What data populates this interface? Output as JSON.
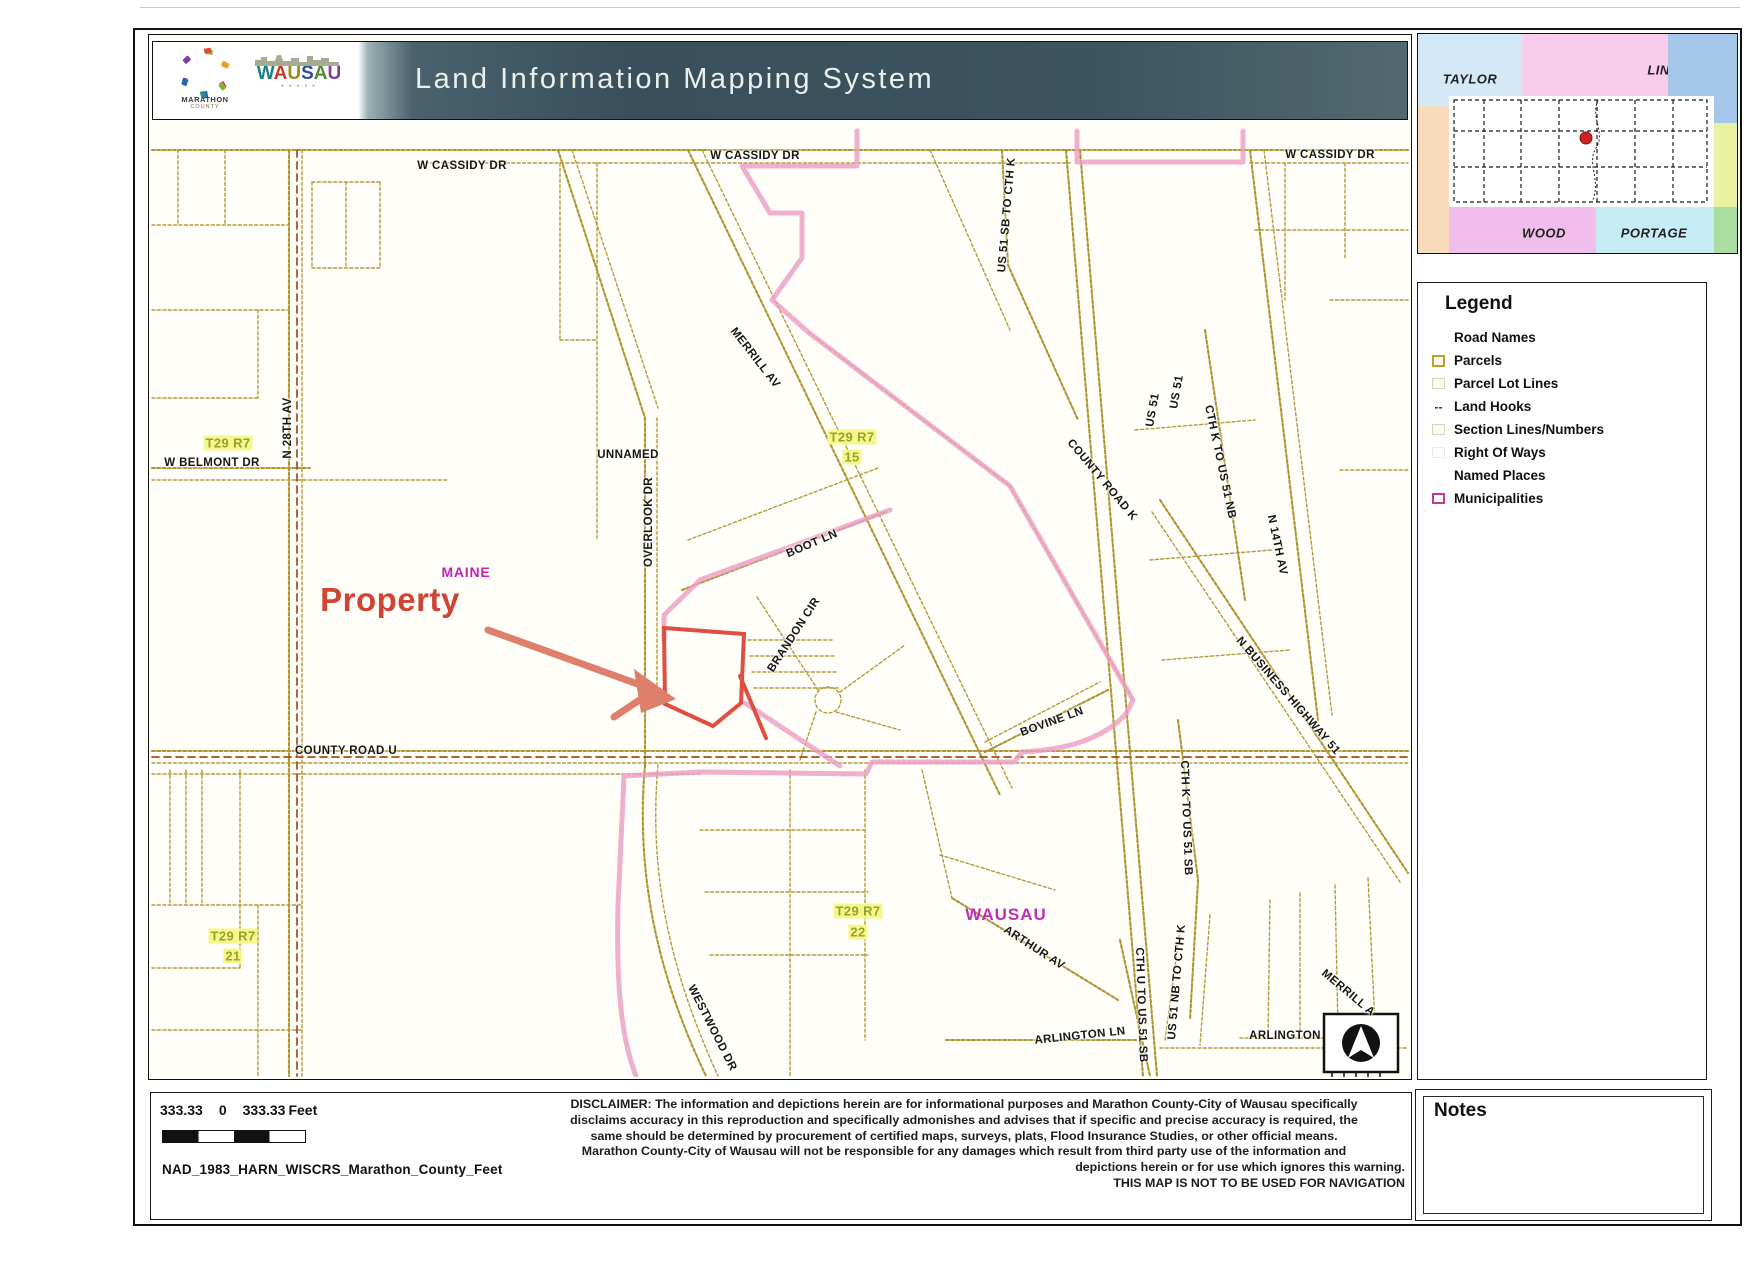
{
  "header": {
    "title": "Land Information Mapping System",
    "marathon_logo": {
      "name": "MARATHON",
      "sub": "COUNTY"
    },
    "wausau_logo": {
      "name": "WAUSAU",
      "letter_colors": [
        "#1b7f8a",
        "#c43a2c",
        "#9a8a1a",
        "#2a4d9c",
        "#4e8d2f",
        "#7d3f96"
      ],
      "dots": "• • • • •"
    }
  },
  "inset": {
    "cells": [
      {
        "label": "TAYLOR",
        "color": "#d4e9f7",
        "x": 0,
        "y": 0,
        "w": 104,
        "h": 72,
        "lx": 52,
        "ly": 45
      },
      {
        "label": "LINCOLN",
        "color": "#f8cdeb",
        "x": 104,
        "y": 0,
        "w": 146,
        "h": 62,
        "lx": 156,
        "ly": 36
      },
      {
        "label": "",
        "color": "#a4c7ea",
        "x": 250,
        "y": 0,
        "w": 69,
        "h": 89
      },
      {
        "label": "",
        "color": "#f8dbba",
        "x": 0,
        "y": 72,
        "w": 31,
        "h": 147
      },
      {
        "label": "",
        "color": "#eaf1a3",
        "x": 296,
        "y": 89,
        "w": 23,
        "h": 84
      },
      {
        "label": "",
        "color": "#ffffff",
        "x": 31,
        "y": 62,
        "w": 265,
        "h": 111
      },
      {
        "label": "WOOD",
        "color": "#f0bdec",
        "x": 31,
        "y": 173,
        "w": 147,
        "h": 46,
        "lx": 95,
        "ly": 26
      },
      {
        "label": "PORTAGE",
        "color": "#c7ecf5",
        "x": 178,
        "y": 173,
        "w": 118,
        "h": 46,
        "lx": 58,
        "ly": 26
      },
      {
        "label": "",
        "color": "#acdda0",
        "x": 296,
        "y": 173,
        "w": 23,
        "h": 46
      }
    ]
  },
  "legend": {
    "title": "Legend",
    "items": [
      {
        "label": "Road Names",
        "icon": "none"
      },
      {
        "label": "Parcels",
        "icon": "parcel"
      },
      {
        "label": "Parcel Lot Lines",
        "icon": "faint"
      },
      {
        "label": "Land Hooks",
        "icon": "dash"
      },
      {
        "label": "Section Lines/Numbers",
        "icon": "faint"
      },
      {
        "label": "Right Of Ways",
        "icon": "faint2"
      },
      {
        "label": "Named Places",
        "icon": "none"
      },
      {
        "label": "Municipalities",
        "icon": "muni"
      }
    ]
  },
  "notes": {
    "title": "Notes"
  },
  "footer": {
    "scale_left": "333.33",
    "scale_zero": "0",
    "scale_right": "333.33",
    "scale_unit": "Feet",
    "projection": "NAD_1983_HARN_WISCRS_Marathon_County_Feet",
    "disclaimer_lines": [
      {
        "text": "DISCLAIMER: The information and depictions herein are for informational purposes and Marathon County-City of Wausau specifically",
        "align": "center"
      },
      {
        "text": "disclaims accuracy in this reproduction and specifically admonishes and advises that if specific and precise accuracy is required, the",
        "align": "center"
      },
      {
        "text": "same should be determined by procurement of certified maps, surveys, plats, Flood Insurance Studies, or other official means.",
        "align": "center"
      },
      {
        "text": "Marathon County-City of Wausau will not be responsible for any damages which result from third party use of the information and",
        "align": "center"
      },
      {
        "text": "depictions herein or for use which ignores this warning.",
        "align": "right"
      },
      {
        "text": "THIS MAP IS NOT TO BE USED FOR NAVIGATION",
        "align": "right"
      }
    ]
  },
  "map": {
    "callout": {
      "label": "Property",
      "target": "highlighted parcel"
    },
    "labels": [
      {
        "text": "W CASSIDY DR",
        "x": 462,
        "y": 166,
        "rot": 0,
        "cls": "rd"
      },
      {
        "text": "W CASSIDY DR",
        "x": 755,
        "y": 156,
        "rot": 0,
        "cls": "rd"
      },
      {
        "text": "W CASSIDY DR",
        "x": 1330,
        "y": 155,
        "rot": 0,
        "cls": "rd"
      },
      {
        "text": "N 28TH AV",
        "x": 288,
        "y": 428,
        "rot": -90,
        "cls": "rd"
      },
      {
        "text": "T29 R7",
        "x": 228,
        "y": 443,
        "rot": 0,
        "cls": "twp"
      },
      {
        "text": "W BELMONT DR",
        "x": 212,
        "y": 463,
        "rot": 0,
        "cls": "rd"
      },
      {
        "text": "T29 R7",
        "x": 852,
        "y": 437,
        "rot": 0,
        "cls": "twp"
      },
      {
        "text": "15",
        "x": 852,
        "y": 457,
        "rot": 0,
        "cls": "twp"
      },
      {
        "text": "MERRILL AV",
        "x": 755,
        "y": 358,
        "rot": 52,
        "cls": "rd"
      },
      {
        "text": "UNNAMED",
        "x": 628,
        "y": 455,
        "rot": 0,
        "cls": "rd"
      },
      {
        "text": "OVERLOOK DR",
        "x": 649,
        "y": 522,
        "rot": -90,
        "cls": "rd"
      },
      {
        "text": "BOOT LN",
        "x": 812,
        "y": 544,
        "rot": -23,
        "cls": "rd"
      },
      {
        "text": "BRANDON CIR",
        "x": 794,
        "y": 635,
        "rot": -57,
        "cls": "rd"
      },
      {
        "text": "MAINE",
        "x": 466,
        "y": 572,
        "rot": 0,
        "cls": "maine"
      },
      {
        "text": "Property",
        "x": 390,
        "y": 600,
        "rot": 0,
        "cls": "property"
      },
      {
        "text": "COUNTY ROAD K",
        "x": 1102,
        "y": 480,
        "rot": 50,
        "cls": "rd"
      },
      {
        "text": "US 51 SB TO CTH K",
        "x": 1007,
        "y": 215,
        "rot": -85,
        "cls": "rd"
      },
      {
        "text": "US 51",
        "x": 1177,
        "y": 392,
        "rot": -80,
        "cls": "rd"
      },
      {
        "text": "US 51",
        "x": 1153,
        "y": 410,
        "rot": -80,
        "cls": "rd"
      },
      {
        "text": "CTH K TO US 51 NB",
        "x": 1220,
        "y": 462,
        "rot": 78,
        "cls": "rd"
      },
      {
        "text": "N 14TH AV",
        "x": 1277,
        "y": 545,
        "rot": 78,
        "cls": "rd"
      },
      {
        "text": "N BUSINESS HIGHWAY 51",
        "x": 1288,
        "y": 696,
        "rot": 49,
        "cls": "rd"
      },
      {
        "text": "BOVINE LN",
        "x": 1052,
        "y": 722,
        "rot": -20,
        "cls": "rd"
      },
      {
        "text": "COUNTY ROAD U",
        "x": 346,
        "y": 751,
        "rot": 0,
        "cls": "rd"
      },
      {
        "text": "CTH K TO US 51 SB",
        "x": 1186,
        "y": 818,
        "rot": 88,
        "cls": "rd"
      },
      {
        "text": "T29 R7",
        "x": 233,
        "y": 936,
        "rot": 0,
        "cls": "twp"
      },
      {
        "text": "21",
        "x": 233,
        "y": 956,
        "rot": 0,
        "cls": "twp"
      },
      {
        "text": "T29 R7",
        "x": 858,
        "y": 911,
        "rot": 0,
        "cls": "twp"
      },
      {
        "text": "22",
        "x": 858,
        "y": 932,
        "rot": 0,
        "cls": "twp"
      },
      {
        "text": "WAUSAU",
        "x": 1006,
        "y": 915,
        "rot": 0,
        "cls": "wausau"
      },
      {
        "text": "ARTHUR AV",
        "x": 1034,
        "y": 948,
        "rot": 33,
        "cls": "rd"
      },
      {
        "text": "WESTWOOD DR",
        "x": 712,
        "y": 1028,
        "rot": 63,
        "cls": "rd"
      },
      {
        "text": "ARLINGTON LN",
        "x": 1080,
        "y": 1036,
        "rot": -6,
        "cls": "rd"
      },
      {
        "text": "CTH U TO US 51 SB",
        "x": 1141,
        "y": 1005,
        "rot": 88,
        "cls": "rd"
      },
      {
        "text": "US 51 NB TO CTH K",
        "x": 1177,
        "y": 982,
        "rot": -85,
        "cls": "rd"
      },
      {
        "text": "ARLINGTON",
        "x": 1285,
        "y": 1036,
        "rot": 0,
        "cls": "rd"
      },
      {
        "text": "MERRILL A",
        "x": 1348,
        "y": 993,
        "rot": 40,
        "cls": "rd"
      }
    ]
  }
}
